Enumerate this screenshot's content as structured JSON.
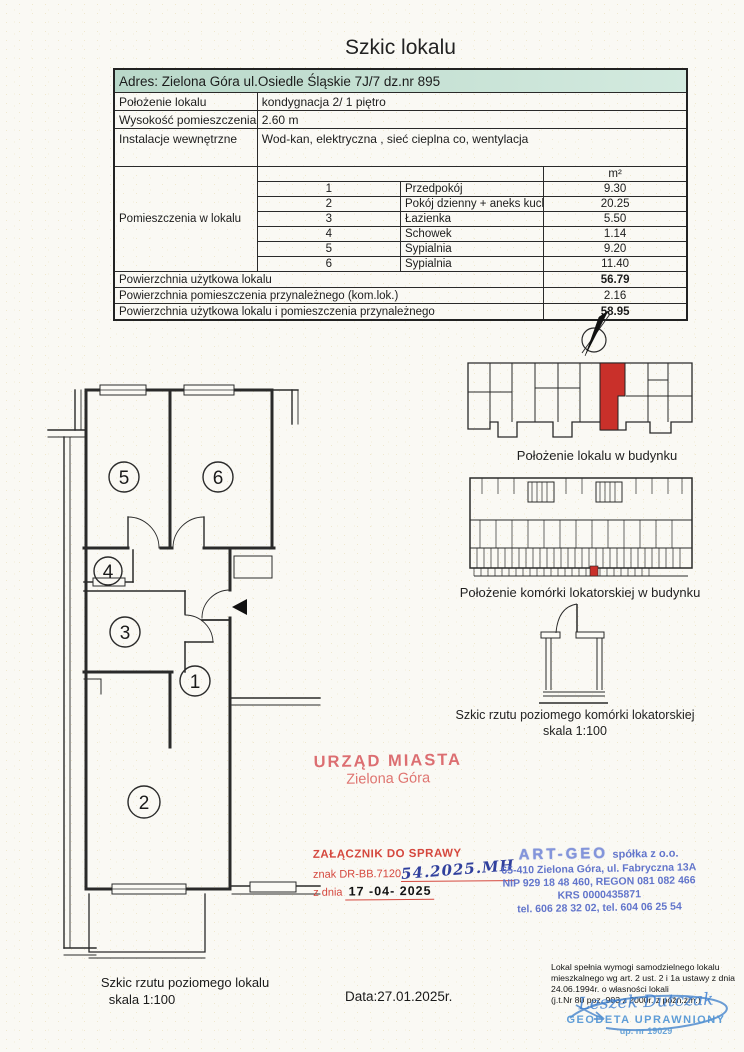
{
  "title": "Szkic lokalu",
  "info_table": {
    "address": "Adres: Zielona Góra ul.Osiedle Śląskie 7J/7 dz.nr 895",
    "rows": [
      {
        "label": "Położenie lokalu",
        "value": "kondygnacja 2/ 1 piętro"
      },
      {
        "label": "Wysokość pomieszczenia",
        "value": "2.60 m"
      },
      {
        "label": "Instalacje wewnętrzne",
        "value": "Wod-kan, elektryczna , sieć cieplna co, wentylacja"
      }
    ],
    "rooms_label": "Pomieszczenia w lokalu",
    "unit_header": "m²",
    "rooms": [
      {
        "no": "1",
        "name": "Przedpokój",
        "area": "9.30"
      },
      {
        "no": "2",
        "name": "Pokój dzienny + aneks kuchenny",
        "area": "20.25"
      },
      {
        "no": "3",
        "name": "Łazienka",
        "area": "5.50"
      },
      {
        "no": "4",
        "name": "Schowek",
        "area": "1.14"
      },
      {
        "no": "5",
        "name": "Sypialnia",
        "area": "9.20"
      },
      {
        "no": "6",
        "name": "Sypialnia",
        "area": "11.40"
      }
    ],
    "summary": [
      {
        "label": "Powierzchnia użytkowa lokalu",
        "value": "56.79"
      },
      {
        "label": "Powierzchnia pomieszczenia przynależnego (kom.lok.)",
        "value": "2.16"
      },
      {
        "label": "Powierzchnia użytkowa lokalu i pomieszczenia przynależnego",
        "value": "58.95"
      }
    ]
  },
  "floor_plan": {
    "room_numbers": [
      "1",
      "2",
      "3",
      "4",
      "5",
      "6"
    ],
    "caption_line1": "Szkic rzutu poziomego lokalu",
    "caption_line2": "skala 1:100"
  },
  "building_diagram": {
    "caption": "Położenie lokalu w budynku",
    "highlight_color": "#c9302a"
  },
  "storage_building_diagram": {
    "caption": "Położenie komórki lokatorskiej w budynku",
    "highlight_color": "#c9302a"
  },
  "storage_sketch": {
    "caption_line1": "Szkic rzutu poziomego komórki lokatorskiej",
    "caption_line2": "skala 1:100"
  },
  "stamps": {
    "city": {
      "line1": "URZĄD MIASTA",
      "line2": "Zielona Góra",
      "color": "#d95f63"
    },
    "attachment": {
      "line1": "ZAŁĄCZNIK DO SPRAWY",
      "ref_prefix": "znak DR-BB.7120",
      "handwritten_ref": "54.2025.MH",
      "date_prefix": "z dnia",
      "date_value": "17 -04- 2025"
    },
    "artgeo": {
      "name": "ART-GEO",
      "name_suffix": "spółka z o.o.",
      "address": "65-410 Zielona Góra, ul. Fabryczna 13A",
      "ids": "NIP 929 18 48 460, REGON 081 082 466",
      "krs": "KRS 0000435871",
      "phones": "tel. 606 28 32 02, tel. 604 06 25 54",
      "color": "#5a6ec9"
    },
    "surveyor": {
      "name": "Leszek Dutczak",
      "title": "GEODETA UPRAWNIONY",
      "license": "up. nr 19029",
      "color": "#4f94d4"
    }
  },
  "legal_note": {
    "line1": "Lokal spełnia wymogi samodzielnego lokalu",
    "line2": "mieszkalnego wg art. 2 ust. 2 i 1a ustawy z dnia",
    "line3": "24.06.1994r. o własności lokali",
    "line4": "(j.t.Nr 80 poz. 903 z 2000r. z późn.zm.)"
  },
  "date_label": "Data:27.01.2025r."
}
